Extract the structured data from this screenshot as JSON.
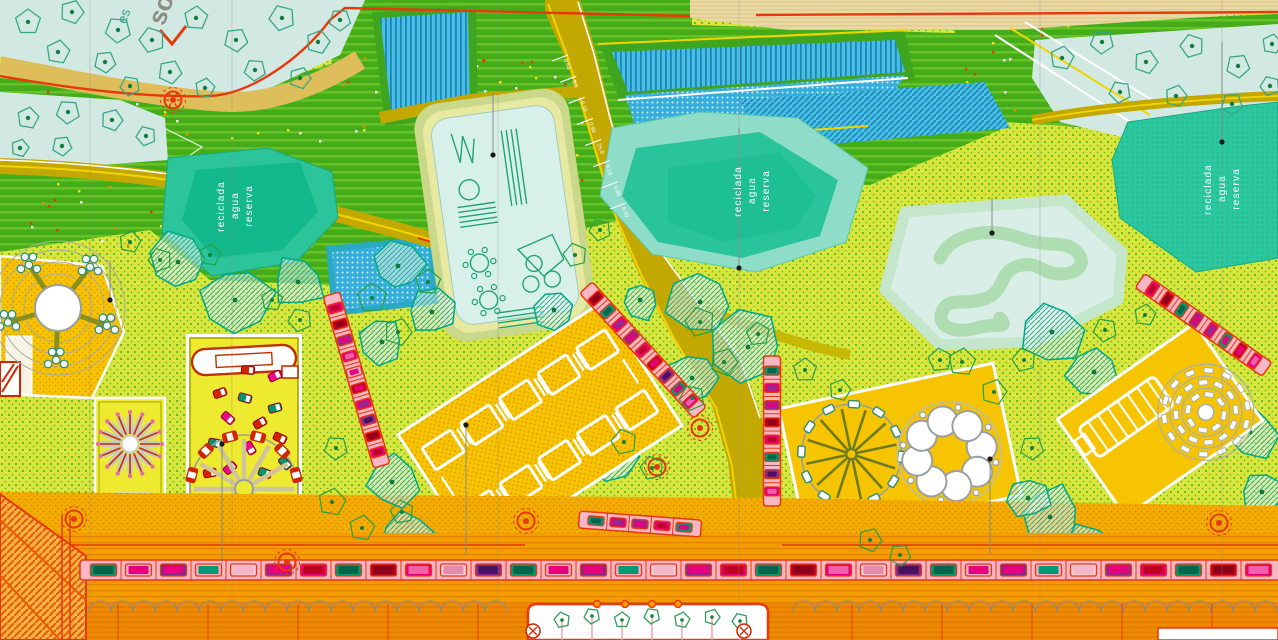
{
  "labels": {
    "pond_words": [
      "reserva",
      "agua",
      "reciclada"
    ]
  },
  "corner": {
    "big": "so",
    "small": "es"
  },
  "road_marks": [
    "0.53",
    "9.0",
    "6.10",
    "0.90",
    "25.0",
    "9.16",
    "0.85",
    "6.40"
  ],
  "palette": {
    "lawn": "#D9E43C",
    "lawn_dot": "#3FB31E",
    "cyan": "#D2E9E3",
    "pond": "#2BC79E",
    "pond_dark": "#13B88C",
    "pond_rim": "#8FDCC8",
    "amber": "#F6C400",
    "yellow": "#EDEA2F",
    "olive": "#C2A800",
    "orange": "#F49C00",
    "orange_deep": "#EF8A00",
    "red": "#E8380D",
    "magenta": "#E6007E",
    "purple": "#7B2E8E",
    "car_green": "#009973",
    "pink": "#F8B7C5",
    "hill": "#44AB19",
    "hill_light": "#66C226",
    "blue": "#46BEE8",
    "wheat": "#EBD9A4",
    "khaki": "#DDBE5A",
    "track_field": "#D9EEE7",
    "track_band": "#AFDDB2",
    "canopy": "#00A886"
  },
  "icons": {
    "lamp": "circle-dot",
    "tree": "pentagon-dot",
    "manhole": "circle-x",
    "bench": "red-chevron"
  },
  "parking": {
    "bottom": [
      [
        "#009973",
        "#00654A"
      ],
      [
        "#F6AEC6",
        "#E6007E"
      ],
      [
        "#7B2E8E",
        "#E6007E"
      ],
      [
        "#F6AEC6",
        "#009973"
      ],
      [
        "#F9C9D6",
        "#F2B8CA"
      ],
      [
        "#8E2D8E",
        "#E6007E"
      ],
      [
        "#E6007E",
        "#C00020"
      ],
      [
        "#009973",
        "#00654A"
      ],
      [
        "#C00020",
        "#8E0018"
      ],
      [
        "#E6007E",
        "#F060A8"
      ],
      [
        "#F9C9D6",
        "#E88AAE"
      ],
      [
        "#7B2E8E",
        "#4A1060"
      ],
      [
        "#009973",
        "#00654A"
      ],
      [
        "#F6AEC6",
        "#E6007E"
      ],
      [
        "#7B2E8E",
        "#E6007E"
      ],
      [
        "#F6AEC6",
        "#009973"
      ],
      [
        "#F9C9D6",
        "#F2B8CA"
      ],
      [
        "#8E2D8E",
        "#E6007E"
      ],
      [
        "#E6007E",
        "#C00020"
      ],
      [
        "#009973",
        "#00654A"
      ],
      [
        "#C00020",
        "#8E0018"
      ],
      [
        "#E6007E",
        "#F060A8"
      ],
      [
        "#F9C9D6",
        "#E88AAE"
      ],
      [
        "#7B2E8E",
        "#4A1060"
      ],
      [
        "#009973",
        "#00654A"
      ],
      [
        "#F6AEC6",
        "#E6007E"
      ],
      [
        "#7B2E8E",
        "#E6007E"
      ],
      [
        "#F6AEC6",
        "#009973"
      ],
      [
        "#F9C9D6",
        "#F2B8CA"
      ],
      [
        "#8E2D8E",
        "#E6007E"
      ],
      [
        "#E6007E",
        "#C00020"
      ],
      [
        "#009973",
        "#00654A"
      ],
      [
        "#C00020",
        "#8E0018"
      ],
      [
        "#E6007E",
        "#F060A8"
      ]
    ],
    "left": [
      [
        "#E6007E",
        "#C00020"
      ],
      [
        "#C00020",
        "#8E0018"
      ],
      [
        "#8E2D8E",
        "#E6007E"
      ],
      [
        "#E6007E",
        "#F060A8"
      ],
      [
        "#F6AEC6",
        "#E6007E"
      ],
      [
        "#C00020",
        "#E6007E"
      ],
      [
        "#E6007E",
        "#8E2D8E"
      ],
      [
        "#8E2D8E",
        "#4A1060"
      ],
      [
        "#C00020",
        "#8E0018"
      ],
      [
        "#E6007E",
        "#C00020"
      ]
    ],
    "mid": [
      [
        "#C00020",
        "#8E0018"
      ],
      [
        "#009973",
        "#00654A"
      ],
      [
        "#E6007E",
        "#8E2D8E"
      ],
      [
        "#8E2D8E",
        "#E6007E"
      ],
      [
        "#E6007E",
        "#C00020"
      ],
      [
        "#C00020",
        "#E6007E"
      ],
      [
        "#8E2D8E",
        "#4A1060"
      ],
      [
        "#009973",
        "#E6007E"
      ],
      [
        "#E6007E",
        "#F060A8"
      ]
    ],
    "vert": [
      [
        "#009973",
        "#00654A"
      ],
      [
        "#E6007E",
        "#8E2D8E"
      ],
      [
        "#8E2D8E",
        "#E6007E"
      ],
      [
        "#C00020",
        "#8E0018"
      ],
      [
        "#E6007E",
        "#C00020"
      ],
      [
        "#009973",
        "#00654A"
      ],
      [
        "#8E2D8E",
        "#4A1060"
      ],
      [
        "#E6007E",
        "#F060A8"
      ]
    ],
    "right": [
      [
        "#E6007E",
        "#C00020"
      ],
      [
        "#C00020",
        "#8E0018"
      ],
      [
        "#009973",
        "#00654A"
      ],
      [
        "#8E2D8E",
        "#E6007E"
      ],
      [
        "#E6007E",
        "#8E2D8E"
      ],
      [
        "#009973",
        "#E6007E"
      ],
      [
        "#C00020",
        "#E6007E"
      ],
      [
        "#E6007E",
        "#F060A8"
      ]
    ],
    "small": [
      [
        "#009973",
        "#00654A"
      ],
      [
        "#E6007E",
        "#8E2D8E"
      ],
      [
        "#8E2D8E",
        "#E6007E"
      ],
      [
        "#E6007E",
        "#C00020"
      ],
      [
        "#009973",
        "#E6007E"
      ]
    ]
  }
}
